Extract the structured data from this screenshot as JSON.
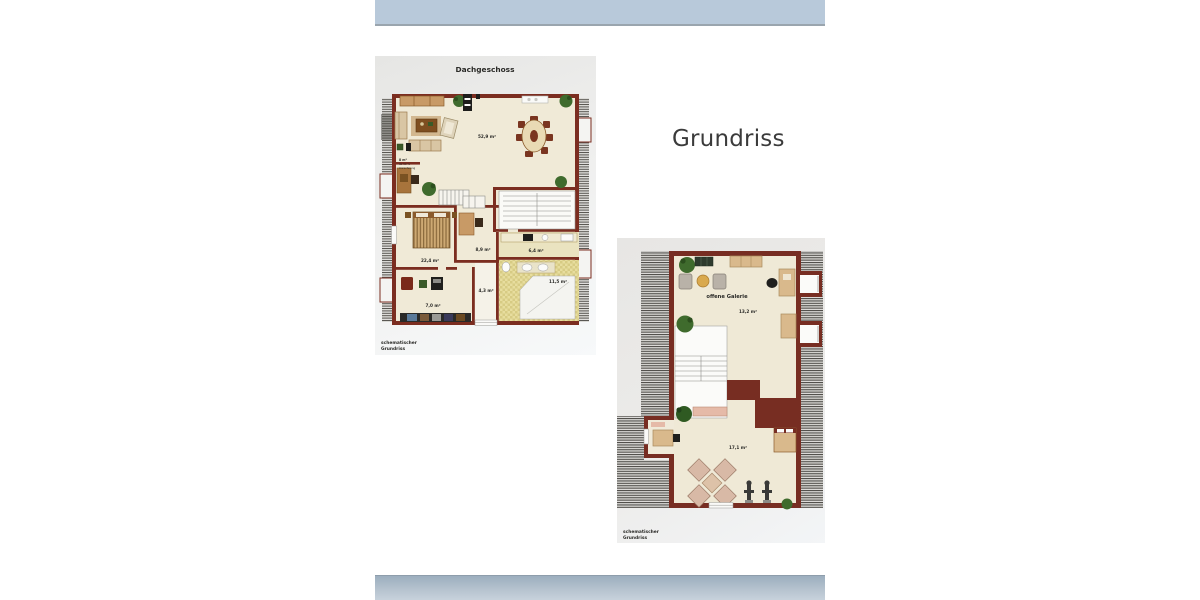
{
  "heading": {
    "title": "Grundriss"
  },
  "plan1": {
    "title": "Dachgeschoss",
    "areas": {
      "living": "52,9 m²",
      "nook_line1": "8 m²",
      "nook_line2": "ab 50 %",
      "nook_line3": "Anrechnung",
      "bedroom": "22,4 m²",
      "study": "8,9 m²",
      "kitchen": "6,4 m²",
      "bath": "11,5 m²",
      "hall": "4,3 m²",
      "storage": "7,0 m²"
    },
    "caption": [
      "schematischer",
      "Grundriss"
    ]
  },
  "plan2": {
    "gallery_label": "offene Galerie",
    "gallery_area": "13,2 m²",
    "room_area": "17,1 m²",
    "caption": [
      "schematischer",
      "Grundriss"
    ]
  },
  "colors": {
    "top_band": "#b8c9da",
    "bottom_band_start": "#9caebe",
    "bottom_band_end": "#c9d3dd",
    "wall": "#7b2d20",
    "floor": "#f0ead7",
    "bath_tile": "#e7dd9e",
    "heading_text": "#3b3b3b"
  }
}
